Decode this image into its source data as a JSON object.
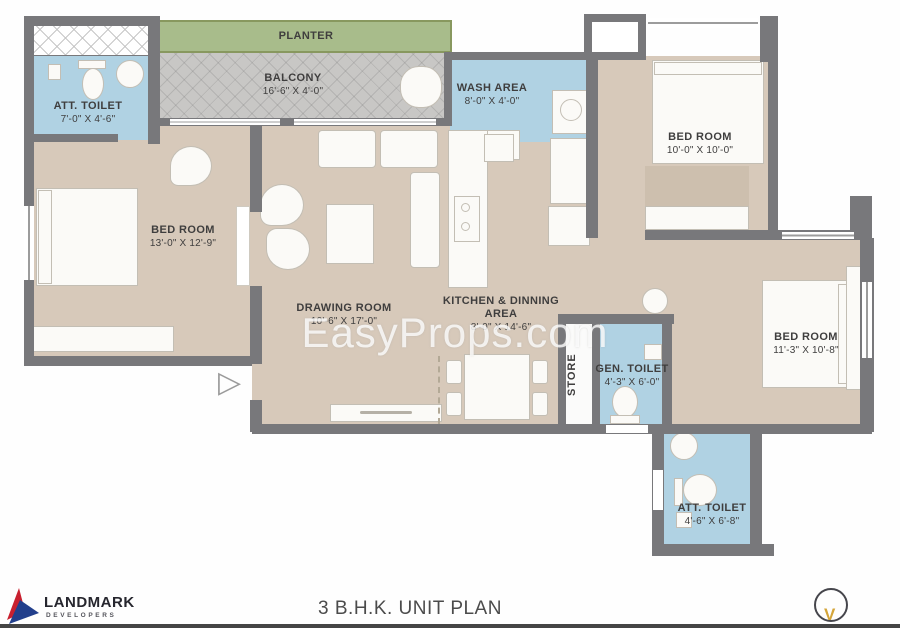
{
  "meta": {
    "plan_title": "3 B.H.K. UNIT PLAN",
    "watermark": "EasyProps.com"
  },
  "logo": {
    "name": "LANDMARK",
    "subtitle": "DEVELOPERS"
  },
  "compass": {
    "glyph": "V"
  },
  "entry": {
    "arrow_glyph": "▷"
  },
  "rooms": {
    "planter": {
      "label": "PLANTER"
    },
    "balcony": {
      "label": "BALCONY",
      "dim": "16'-6\" X 4'-0\""
    },
    "wash_area": {
      "label": "WASH AREA",
      "dim": "8'-0\" X 4'-0\""
    },
    "att_toilet_1": {
      "label": "ATT. TOILET",
      "dim": "7'-0\" X 4'-6\""
    },
    "bedroom_left": {
      "label": "BED ROOM",
      "dim": "13'-0\" X 12'-9\""
    },
    "bedroom_top_right": {
      "label": "BED ROOM",
      "dim": "10'-0\" X 10'-0\""
    },
    "drawing_room": {
      "label": "DRAWING ROOM",
      "dim": "10'-6\" X 17'-0\""
    },
    "kitchen_dining": {
      "label": "KITCHEN & DINNING",
      "label_line2": "AREA",
      "dim": "8'-0\" X 14'-6\""
    },
    "store": {
      "label": "STORE"
    },
    "gen_toilet": {
      "label": "GEN. TOILET",
      "dim": "4'-3\" X 6'-0\""
    },
    "bedroom_right": {
      "label": "BED ROOM",
      "dim": "11'-3\" X 10'-8\""
    },
    "att_toilet_2": {
      "label": "ATT. TOILET",
      "dim": "4'-6\" X 6'-8\""
    }
  },
  "colors": {
    "wall": "#78787b",
    "floor": "#d7c9ba",
    "wet_area": "#b0d2e3",
    "planter_green": "#a8bc8b",
    "balcony_gray": "#c8c7c5",
    "logo_red": "#c8202f",
    "logo_blue": "#223f8c",
    "compass_gold": "#d4a53a"
  }
}
